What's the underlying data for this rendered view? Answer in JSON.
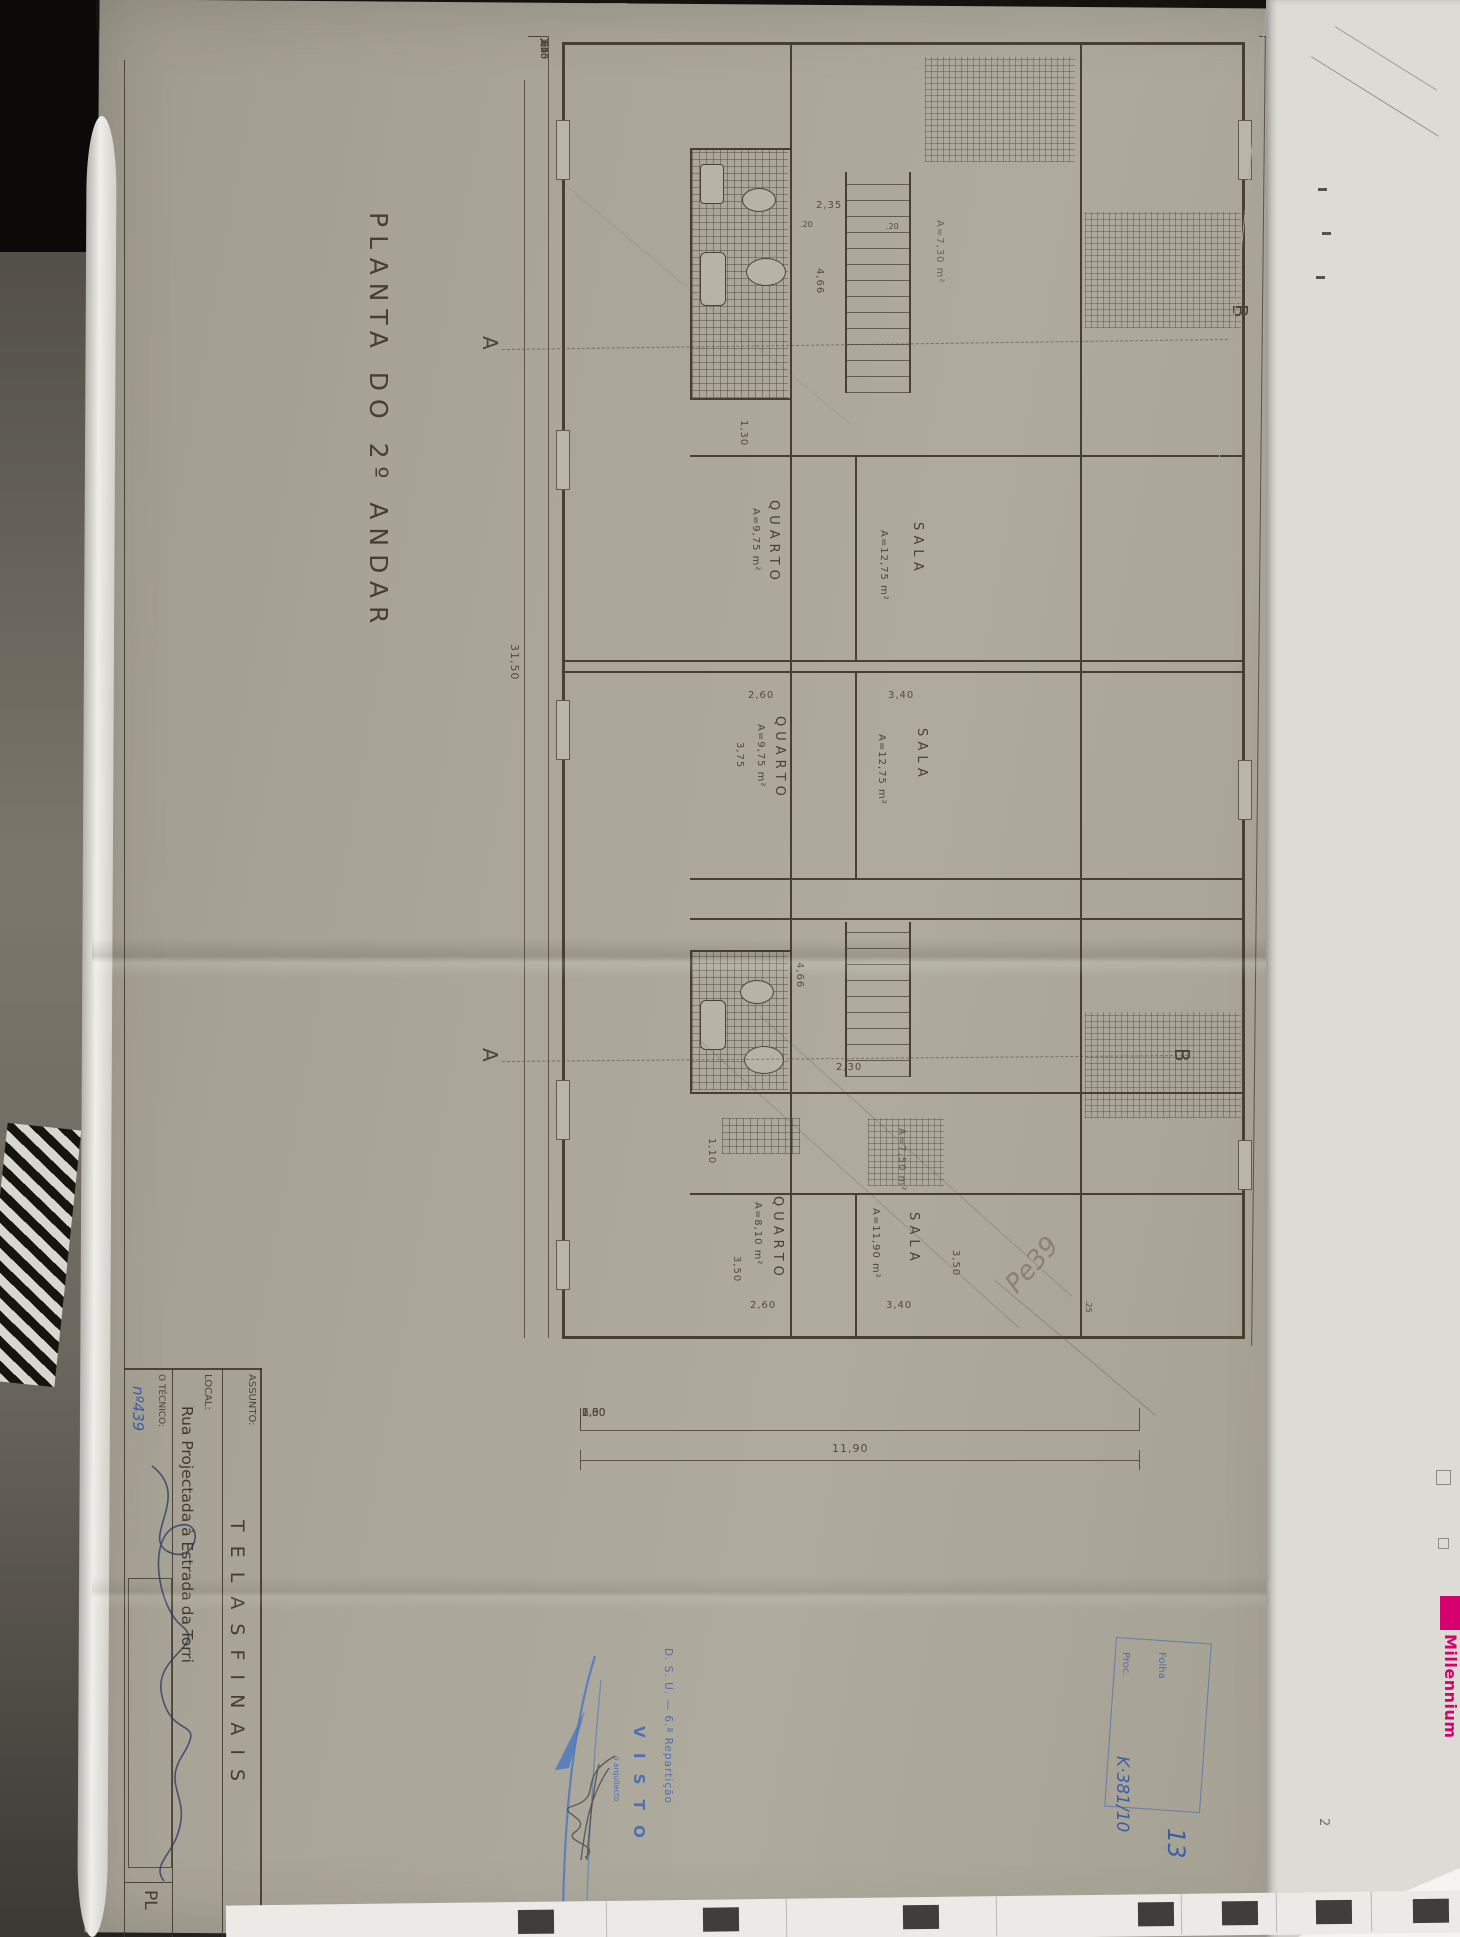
{
  "colors": {
    "paper": "#a8a497",
    "ink": "#4a4539",
    "stamp_blue": "#4f6fae",
    "handwriting_blue": "#3a5fa8",
    "brand_magenta": "#d6006e"
  },
  "env": {
    "brand_vertical": "Millennium",
    "stray_note": "2"
  },
  "sheet": {
    "title": "PLANTA DO 2º ANDAR",
    "markers": {
      "a": "A",
      "b": "B"
    },
    "rooms": {
      "u1_quarto": {
        "name": "QUARTO",
        "area": "A=9,75 m²"
      },
      "u1_sala": {
        "name": "SALA",
        "area": "A=12,75 m²"
      },
      "u2_quarto": {
        "name": "QUARTO",
        "area": "A=9,75 m²"
      },
      "u2_sala": {
        "name": "SALA",
        "area": "A=12,75 m²"
      },
      "u3_quarto": {
        "name": "QUARTO",
        "area": "A=8,10 m²"
      },
      "u3_sala": {
        "name": "SALA",
        "area": "A=11,90 m²"
      },
      "balc1_area": "A=7,30 m²",
      "balc2_area": "A=7,50 m²"
    },
    "dims": {
      "left_chain": [
        "1,40",
        ",55",
        ",65",
        ",55",
        ",80",
        "3,25",
        ",80",
        ",65",
        ",80",
        ",95",
        "1,40",
        "3,55",
        "1,40",
        "1,25",
        ",80",
        ",50",
        ",80",
        "3,05",
        ",70",
        ",50",
        ",80",
        ",50",
        "1,40",
        "2,10"
      ],
      "left_total": "31,50",
      "right_chain": [
        "1,10",
        "1,50",
        "1,20",
        "2,05",
        "1,20",
        "1,95",
        "1,00",
        "1,40",
        "2,80",
        "1,40",
        "1,25",
        "1,45",
        "1,20",
        "2,00",
        "1,20",
        "2,40",
        "1,85",
        "1,40",
        "1,25"
      ],
      "right_total": "31,50",
      "bottom_chain": [
        "2,30",
        "6,60",
        "2,00",
        "1,00"
      ],
      "bottom_total": "11,90",
      "corridor_w": "2,35",
      "corridor_len_a": "4,66",
      "corridor_len_b": "4,66",
      "hall_b": "2,30",
      "one_30": "1,30",
      "one_10": "1,10",
      "u2_quarto_w": "2,60",
      "u2_sala_w": "3,40",
      "u2_quarto_d": "3,75",
      "u3_quarto_w": "2,60",
      "u3_sala_w": "3,40",
      "u3_quarto_d": "3,50",
      "u3_sala_d": "3,50",
      "tick_small": ".20",
      "tick_small2": ".20",
      "tick_25": ".25"
    },
    "title_block": {
      "assunto_label": "ASSUNTO:",
      "assunto_value": "T E L A S   F I N A I S",
      "local_label": "LOCAL:",
      "local_value": "Rua Projectada à Estrada da Torri",
      "tecnico_label": "O TÉCNICO:",
      "tecnico_number": "nº439",
      "sheet_code": "PL"
    },
    "stamps": {
      "folha_label": "Folha",
      "folha_value": "13",
      "proc_label": "Proc.",
      "proc_value": "K·381/10",
      "visto_dept": "D. S. U. — 6.ª Repartição",
      "visto_word": "V I S T O",
      "visto_role": "o arquitecto",
      "pencil_note": "Pe39"
    }
  }
}
